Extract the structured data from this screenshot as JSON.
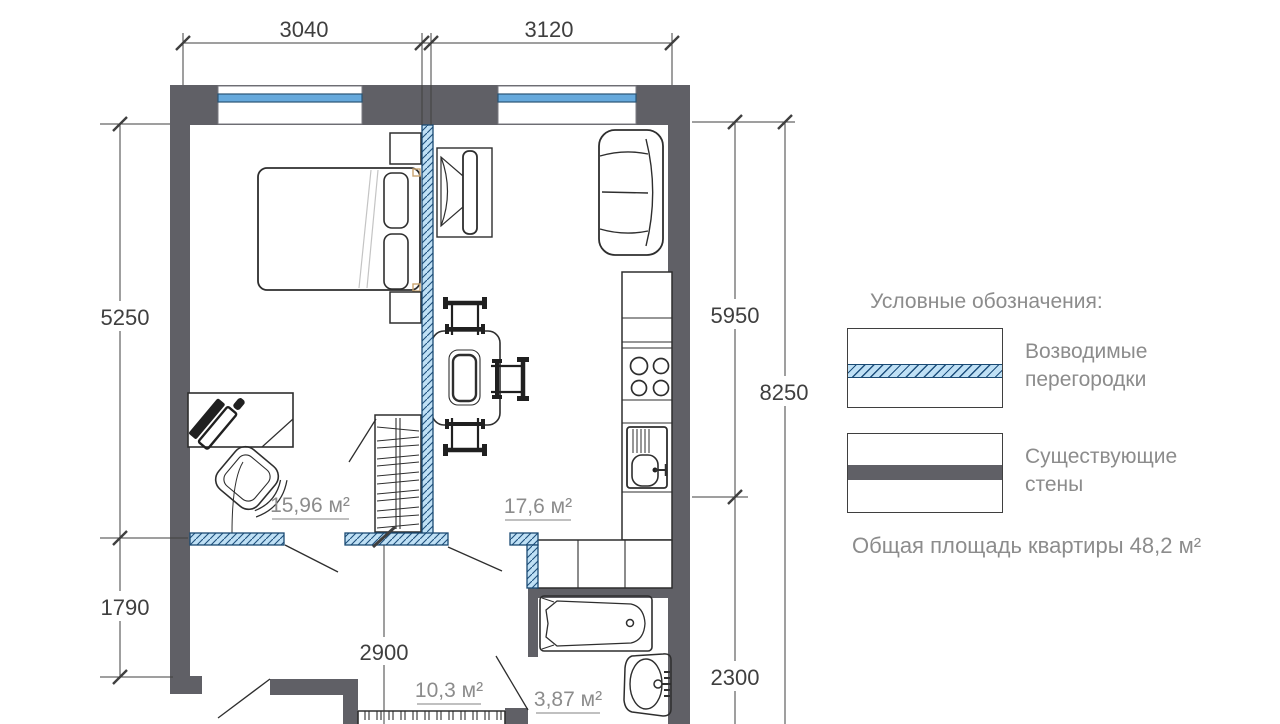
{
  "plan": {
    "dim_top": [
      "3040",
      "3120"
    ],
    "dim_left": [
      "5250",
      "1790"
    ],
    "dim_right": [
      "5950",
      "2300"
    ],
    "dim_right_total": "8250",
    "dim_hall": "2900",
    "rooms": {
      "bedroom": "15,96 м²",
      "living_kitchen": "17,6 м²",
      "hall": "10,3 м²",
      "bathroom": "3,87 м²"
    }
  },
  "legend": {
    "title": "Условные обозначения:",
    "item_partitions": "Возводимые перегородки",
    "item_walls": "Существующие стены",
    "total_area": "Общая площадь квартиры 48,2 м²"
  },
  "colors": {
    "existing_wall": "#606066",
    "partition_fill": "#bfe0f5",
    "partition_line": "#1d4f7c",
    "window_glass": "#66a9dc",
    "dimension_text": "#3f3f3f",
    "label_text": "#8c8c8c"
  }
}
